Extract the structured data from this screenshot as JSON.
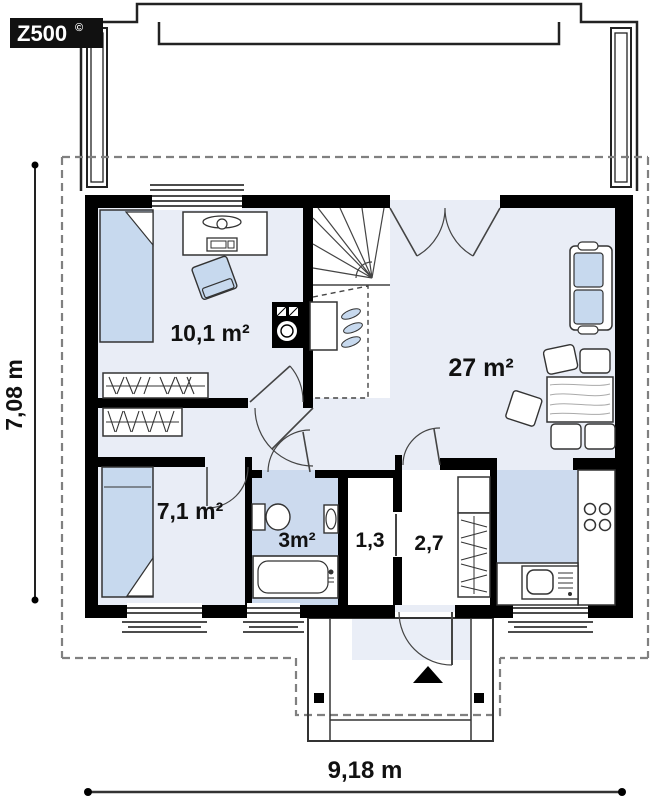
{
  "logo": {
    "text": "Z500",
    "sup": "©"
  },
  "plan": {
    "rooms": [
      {
        "id": "bedroom-1",
        "area_label": "10,1 m²"
      },
      {
        "id": "living-room",
        "area_label": "27 m²"
      },
      {
        "id": "bedroom-2",
        "area_label": "7,1 m²"
      },
      {
        "id": "bathroom",
        "area_label": "3m²"
      },
      {
        "id": "closet",
        "area_label": "1,3"
      },
      {
        "id": "entry-hall",
        "area_label": "2,7"
      }
    ],
    "dimensions": {
      "width_label": "9,18 m",
      "depth_label": "7,08 m"
    },
    "colors": {
      "wall": "#000000",
      "floor": "#e9edf6",
      "wet_floor": "#ccdaee",
      "furniture_blue": "#c7d9ee",
      "dashed_boundary": "#808080"
    }
  }
}
